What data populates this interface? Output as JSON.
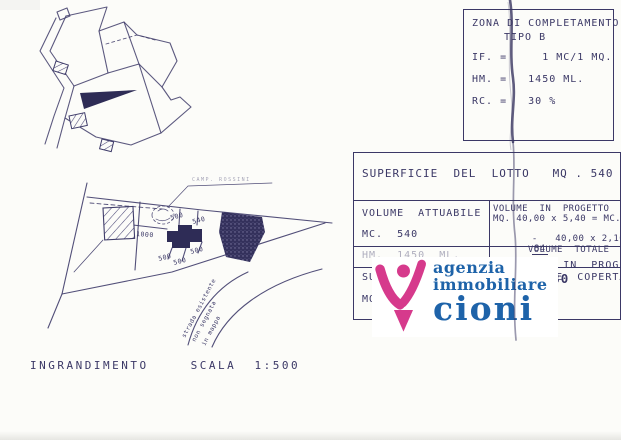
{
  "scan": {
    "ink": "#3b3866",
    "background": "#fcfcf9"
  },
  "zona_box": {
    "title_line1": "ZONA DI COMPLETAMENTO",
    "title_line2": "TIPO B",
    "if_line": "IF. =     1 MC/1 MQ.",
    "hm_line": "HM. =   1450 ML.",
    "rc_line": "RC. =   30 %"
  },
  "lot_table": {
    "row1": "SUPERFICIE  DEL  LOTTO   MQ . 540",
    "volume_attuabile_label": "VOLUME  ATTUABILE",
    "volume_attuabile_value": "MC.  540",
    "volume_progetto_title": "VOLUME  IN  PROGETTO",
    "volume_progetto_calc1": "MQ. 40,00 x 5,40 = MC. 216",
    "volume_progetto_calc2": "-   40,00 x 2,10 =  -",
    "volume_progetto_calc2_result": "84",
    "volume_progetto_total_label": "VOLUME  TOTALE  mc",
    "volume_progetto_total_value": "300",
    "hm_left": "HM.  1450  ML.",
    "hm_right_label": "HM  IN  PROGETTO ",
    "hm_right_value": "8,80",
    "sup_left_line1": "SUPERFICIE",
    "sup_left_line2": "MQ.",
    "sup_right_line1": "SUPERFICIE  COPERTA",
    "sup_right_line2": "000"
  },
  "logo": {
    "word1": "agenzia",
    "word2": "immobiliare",
    "word3": "cioni",
    "pink": "#d63a8c",
    "blue": "#1e63a9"
  },
  "enlargement": {
    "caption_word1": "INGRANDIMENTO",
    "caption_word2": "SCALA  1:500",
    "top_label": "CAMP.  ROSSINI",
    "dim_top1": "500",
    "dim_top2": "540",
    "dim_left": "1000",
    "dim_bottom1": "500",
    "dim_bottom2": "500",
    "dim_bottom3": "500",
    "road_line1": "strada esistente",
    "road_line2": "non segnata",
    "road_line3": "in mappa"
  }
}
